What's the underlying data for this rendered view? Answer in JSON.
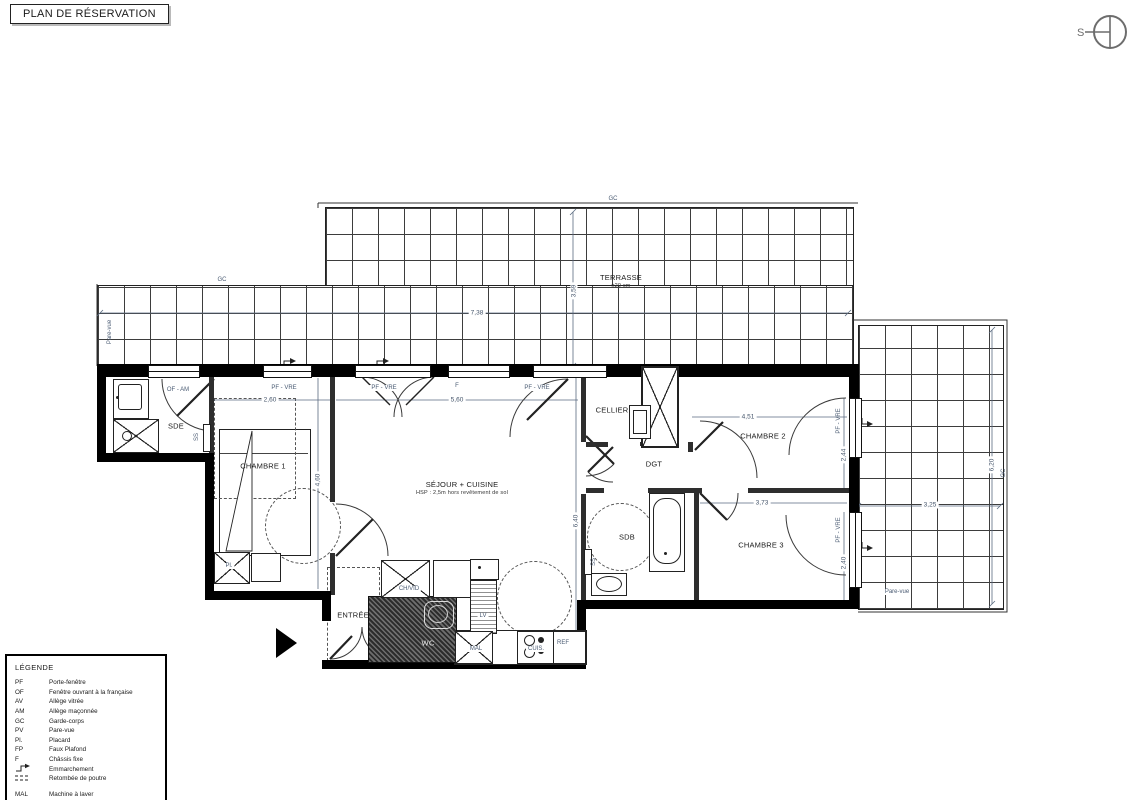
{
  "title": "PLAN DE RÉSERVATION",
  "compass": {
    "label": "S"
  },
  "plan": {
    "rooms": [
      {
        "id": "terrasse",
        "text": "TERRASSE",
        "sub": "±20 cm",
        "x": 621,
        "y": 281
      },
      {
        "id": "sde",
        "text": "SDE",
        "x": 176,
        "y": 426
      },
      {
        "id": "chambre-1",
        "text": "CHAMBRE 1",
        "x": 263,
        "y": 466
      },
      {
        "id": "sejour-cuisine",
        "text": "SÉJOUR + CUISINE",
        "sub": "HSP : 2,5m hors revêtement de sol",
        "x": 462,
        "y": 488
      },
      {
        "id": "cellier",
        "text": "CELLIER",
        "x": 612,
        "y": 410
      },
      {
        "id": "dgt",
        "text": "DGT",
        "x": 654,
        "y": 464
      },
      {
        "id": "chambre-2",
        "text": "CHAMBRE 2",
        "x": 763,
        "y": 436
      },
      {
        "id": "sdb",
        "text": "SDB",
        "x": 627,
        "y": 537
      },
      {
        "id": "chambre-3",
        "text": "CHAMBRE 3",
        "x": 761,
        "y": 545
      },
      {
        "id": "entree",
        "text": "ENTRÉE",
        "x": 353,
        "y": 615
      },
      {
        "id": "wc",
        "text": "WC",
        "x": 428,
        "y": 643,
        "light": true
      }
    ],
    "annotations": [
      {
        "text": "GC",
        "x": 613,
        "y": 199
      },
      {
        "text": "GC",
        "x": 222,
        "y": 280
      },
      {
        "text": "GC",
        "x": 1004,
        "y": 473,
        "rot": true
      },
      {
        "text": "Pare-vue",
        "x": 110,
        "y": 332,
        "rot": true
      },
      {
        "text": "Pare-vue",
        "x": 897,
        "y": 592,
        "chip": true
      },
      {
        "text": "OF - AM",
        "x": 178,
        "y": 390,
        "chip": true
      },
      {
        "text": "PF - VRE",
        "x": 284,
        "y": 388,
        "chip": true
      },
      {
        "text": "PF - VRE",
        "x": 384,
        "y": 388,
        "chip": true
      },
      {
        "text": "F",
        "x": 457,
        "y": 386,
        "chip": true
      },
      {
        "text": "PF - VRE",
        "x": 537,
        "y": 388,
        "chip": true
      },
      {
        "text": "PF - VRE",
        "x": 839,
        "y": 421,
        "rot": true
      },
      {
        "text": "PF - VRE",
        "x": 839,
        "y": 530,
        "rot": true
      },
      {
        "text": "SS",
        "x": 197,
        "y": 437,
        "rot": true
      },
      {
        "text": "SS",
        "x": 594,
        "y": 562,
        "rot": true
      },
      {
        "text": "Pl.",
        "x": 229,
        "y": 566,
        "chip": true
      },
      {
        "text": "CH/VID",
        "x": 409,
        "y": 589,
        "chip": true
      },
      {
        "text": "LV",
        "x": 483,
        "y": 616,
        "chip": true
      },
      {
        "text": "MAL",
        "x": 476,
        "y": 649,
        "chip": true
      },
      {
        "text": "CUIS.",
        "x": 536,
        "y": 649,
        "chip": true
      },
      {
        "text": "REF",
        "x": 563,
        "y": 643,
        "chip": true
      }
    ],
    "dimensions": [
      {
        "text": "7,38",
        "x": 477,
        "y": 313
      },
      {
        "text": "3,59",
        "x": 574,
        "y": 291,
        "rot": true
      },
      {
        "text": "2,60",
        "x": 270,
        "y": 400
      },
      {
        "text": "5,60",
        "x": 457,
        "y": 400
      },
      {
        "text": "4,51",
        "x": 748,
        "y": 417
      },
      {
        "text": "3,73",
        "x": 762,
        "y": 503
      },
      {
        "text": "4,60",
        "x": 318,
        "y": 480,
        "rot": true
      },
      {
        "text": "6,40",
        "x": 576,
        "y": 521,
        "rot": true
      },
      {
        "text": "2,44",
        "x": 844,
        "y": 455,
        "rot": true
      },
      {
        "text": "2,40",
        "x": 844,
        "y": 563,
        "rot": true
      },
      {
        "text": "3,25",
        "x": 930,
        "y": 505
      },
      {
        "text": "6,20",
        "x": 992,
        "y": 465,
        "rot": true
      }
    ]
  },
  "legend": {
    "heading": "LÉGENDE",
    "items": [
      {
        "abbr": "PF",
        "label": "Porte-fenêtre"
      },
      {
        "abbr": "OF",
        "label": "Fenêtre ouvrant à la française"
      },
      {
        "abbr": "AV",
        "label": "Allège vitrée"
      },
      {
        "abbr": "AM",
        "label": "Allège maçonnée"
      },
      {
        "abbr": "GC",
        "label": "Garde-corps"
      },
      {
        "abbr": "PV",
        "label": "Pare-vue"
      },
      {
        "abbr": "Pl.",
        "label": "Placard"
      },
      {
        "abbr": "FP",
        "label": "Faux Plafond"
      },
      {
        "abbr": "F",
        "label": "Châssis fixe"
      },
      {
        "abbr": "",
        "icon": "step-icon",
        "label": "Emmarchement"
      },
      {
        "abbr": "",
        "icon": "beam-icon",
        "label": "Retombée de poutre"
      },
      {
        "abbr": "MAL",
        "label": "Machine à laver",
        "gap": true
      },
      {
        "abbr": "LV",
        "label": "Lave-vaisselle"
      },
      {
        "abbr": "SS",
        "label": "Sèche serviette"
      },
      {
        "abbr": "CUIS.",
        "label": "Cuisson"
      }
    ]
  }
}
